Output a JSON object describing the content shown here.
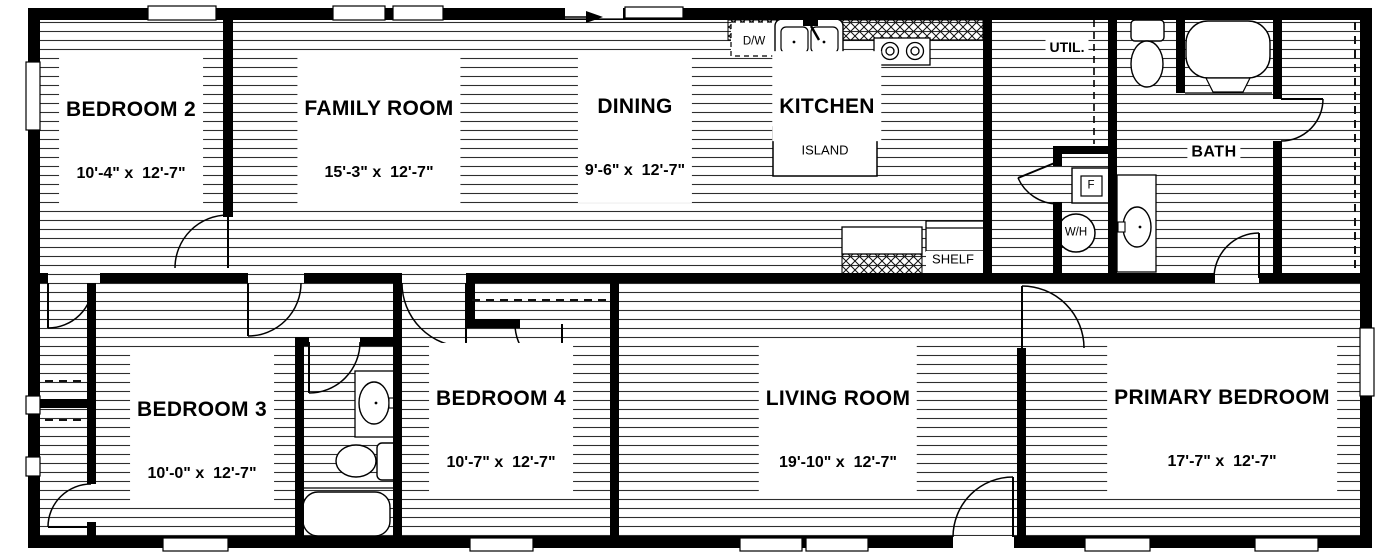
{
  "plan_title": "floor-plan",
  "rooms": [
    {
      "id": "bedroom2",
      "name": "BEDROOM 2",
      "dims": "10'-4\" x  12'-7\""
    },
    {
      "id": "family-room",
      "name": "FAMILY ROOM",
      "dims": "15'-3\" x  12'-7\""
    },
    {
      "id": "dining",
      "name": "DINING",
      "dims": "9'-6\" x  12'-7\""
    },
    {
      "id": "kitchen",
      "name": "KITCHEN",
      "dims": ""
    },
    {
      "id": "bedroom3",
      "name": "BEDROOM 3",
      "dims": "10'-0\" x  12'-7\""
    },
    {
      "id": "bedroom4",
      "name": "BEDROOM 4",
      "dims": "10'-7\" x  12'-7\""
    },
    {
      "id": "living-room",
      "name": "LIVING ROOM",
      "dims": "19'-10\" x  12'-7\""
    },
    {
      "id": "primary-bedroom",
      "name": "PRIMARY BEDROOM",
      "dims": "17'-7\" x  12'-7\""
    }
  ],
  "labels": {
    "util": "UTIL.",
    "bath": "BATH",
    "island": "ISLAND",
    "shelf": "SHELF",
    "dishwasher": "D/W",
    "water_heater": "W/H",
    "furnace": "F"
  },
  "colors": {
    "wall": "#000000",
    "hatch_line": "#2e2e2e",
    "background": "#ffffff"
  }
}
